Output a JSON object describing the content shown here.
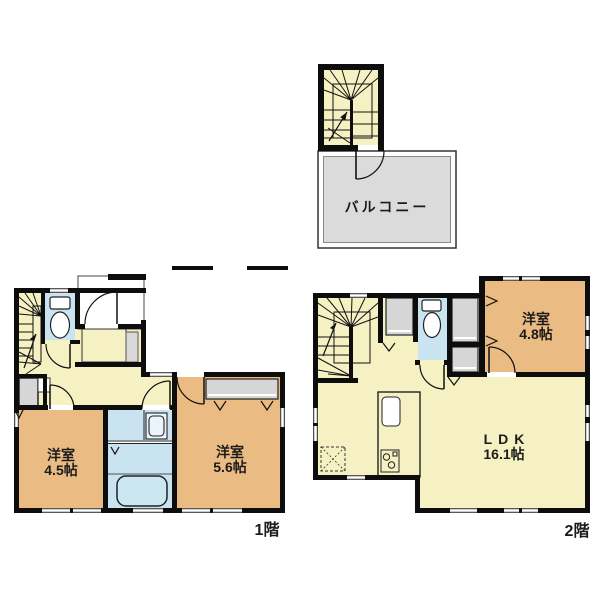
{
  "colors": {
    "room-yellow": "#F6F1C3",
    "room-orange": "#EBBB84",
    "water-blue": "#C9E4F0",
    "tub-blue": "#CDE7F2",
    "balcony-gray": "#DBDBDB",
    "closet-gray": "#D6D6D6",
    "counter-gray": "#D9D9D9",
    "wall-black": "#0d0d0d",
    "text": "#1b1b1b"
  },
  "balcony": {
    "label": "バルコニー"
  },
  "floor1": {
    "label": "1階",
    "rooms": [
      {
        "name": "洋室",
        "size": "4.5帖"
      },
      {
        "name": "洋室",
        "size": "5.6帖"
      }
    ]
  },
  "floor2": {
    "label": "2階",
    "rooms": [
      {
        "name": "洋室",
        "size": "4.8帖"
      },
      {
        "name": "LDK",
        "size": "16.1帖"
      }
    ]
  }
}
